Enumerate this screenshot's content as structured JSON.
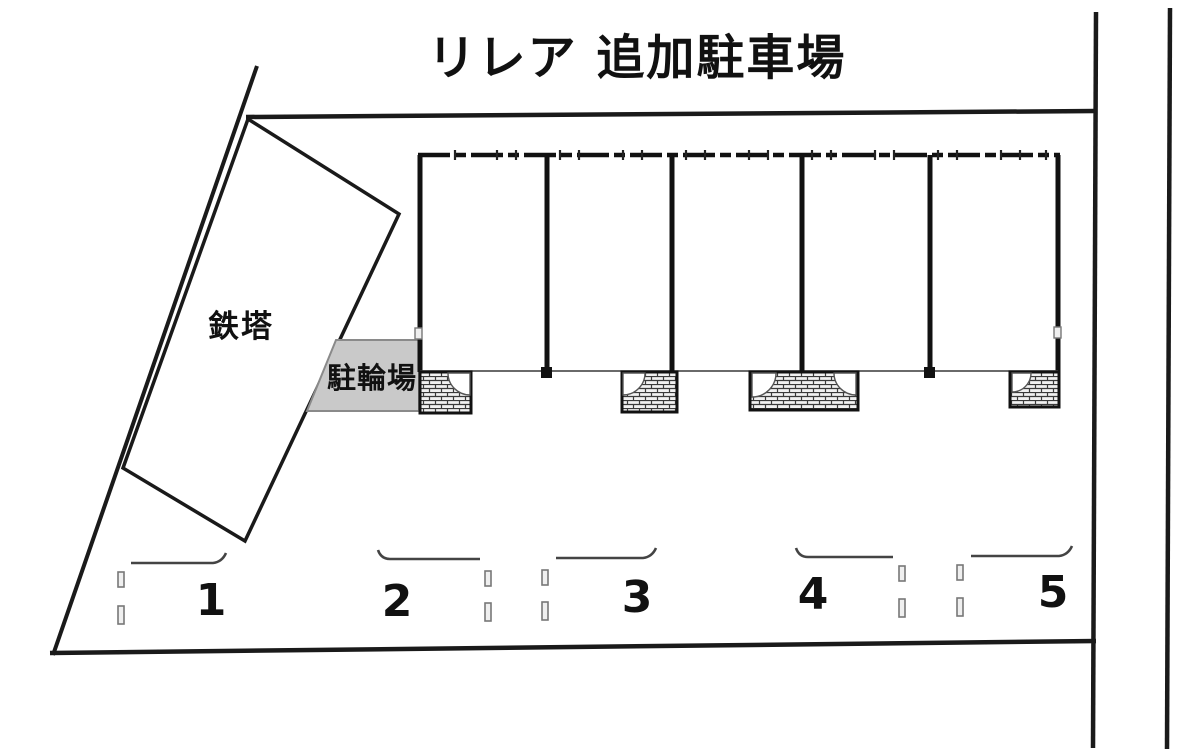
{
  "diagram": {
    "title": "リレア 追加駐車場",
    "tower_label": "鉄塔",
    "bicycle_parking_label": "駐輪場",
    "spaces": [
      {
        "number": "1"
      },
      {
        "number": "2"
      },
      {
        "number": "3"
      },
      {
        "number": "4"
      },
      {
        "number": "5"
      }
    ]
  },
  "colors": {
    "background": "#ffffff",
    "line": "#1a1a1a",
    "thin_line": "#666666",
    "bicycle_box_fill": "#c9c9c9",
    "bicycle_box_stroke": "#8a8a8a",
    "hatch_line": "#3a3a3a",
    "tick_fill": "#efefef",
    "tick_stroke": "#777777"
  }
}
